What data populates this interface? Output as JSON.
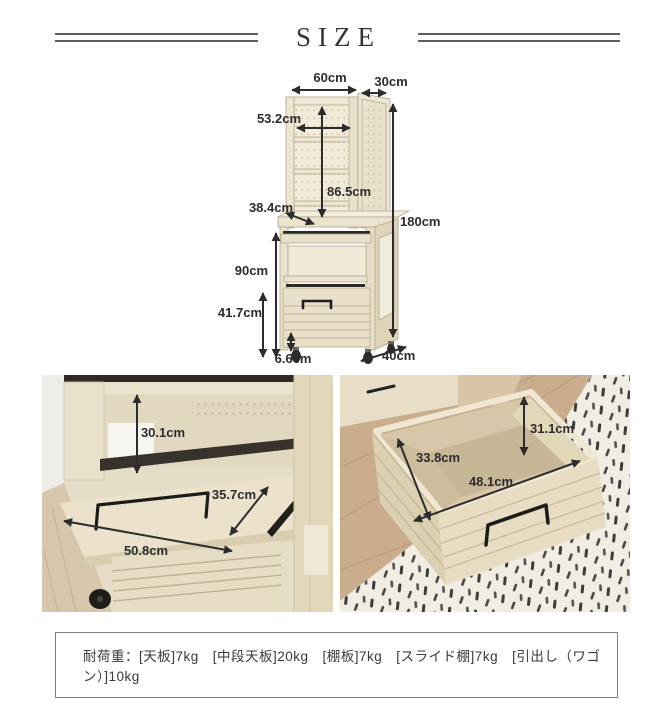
{
  "page": {
    "title": "SIZE"
  },
  "diagram": {
    "labels": {
      "top_width": "60cm",
      "top_depth": "30cm",
      "inner_width": "53.2cm",
      "hutch_height": "86.5cm",
      "shelf_depth": "38.4cm",
      "total_height": "180cm",
      "lower_height": "90cm",
      "wagon_height": "41.7cm",
      "caster_height": "6.6cm",
      "base_depth": "40cm"
    }
  },
  "photo_left": {
    "labels": {
      "open_height": "30.1cm",
      "slide_depth": "35.7cm",
      "slide_width": "50.8cm"
    }
  },
  "photo_right": {
    "labels": {
      "inner_height": "31.1cm",
      "inner_depth": "33.8cm",
      "inner_width": "48.1cm"
    }
  },
  "spec": {
    "load_text": "耐荷重：[天板]7kg　[中段天板]20kg　[棚板]7kg　[スライド棚]7kg　[引出し（ワゴン）]10kg"
  },
  "colors": {
    "dimension_text": "#2c2c2c",
    "wood_light": "#ece3cf",
    "header_line": "#5e5e60"
  }
}
